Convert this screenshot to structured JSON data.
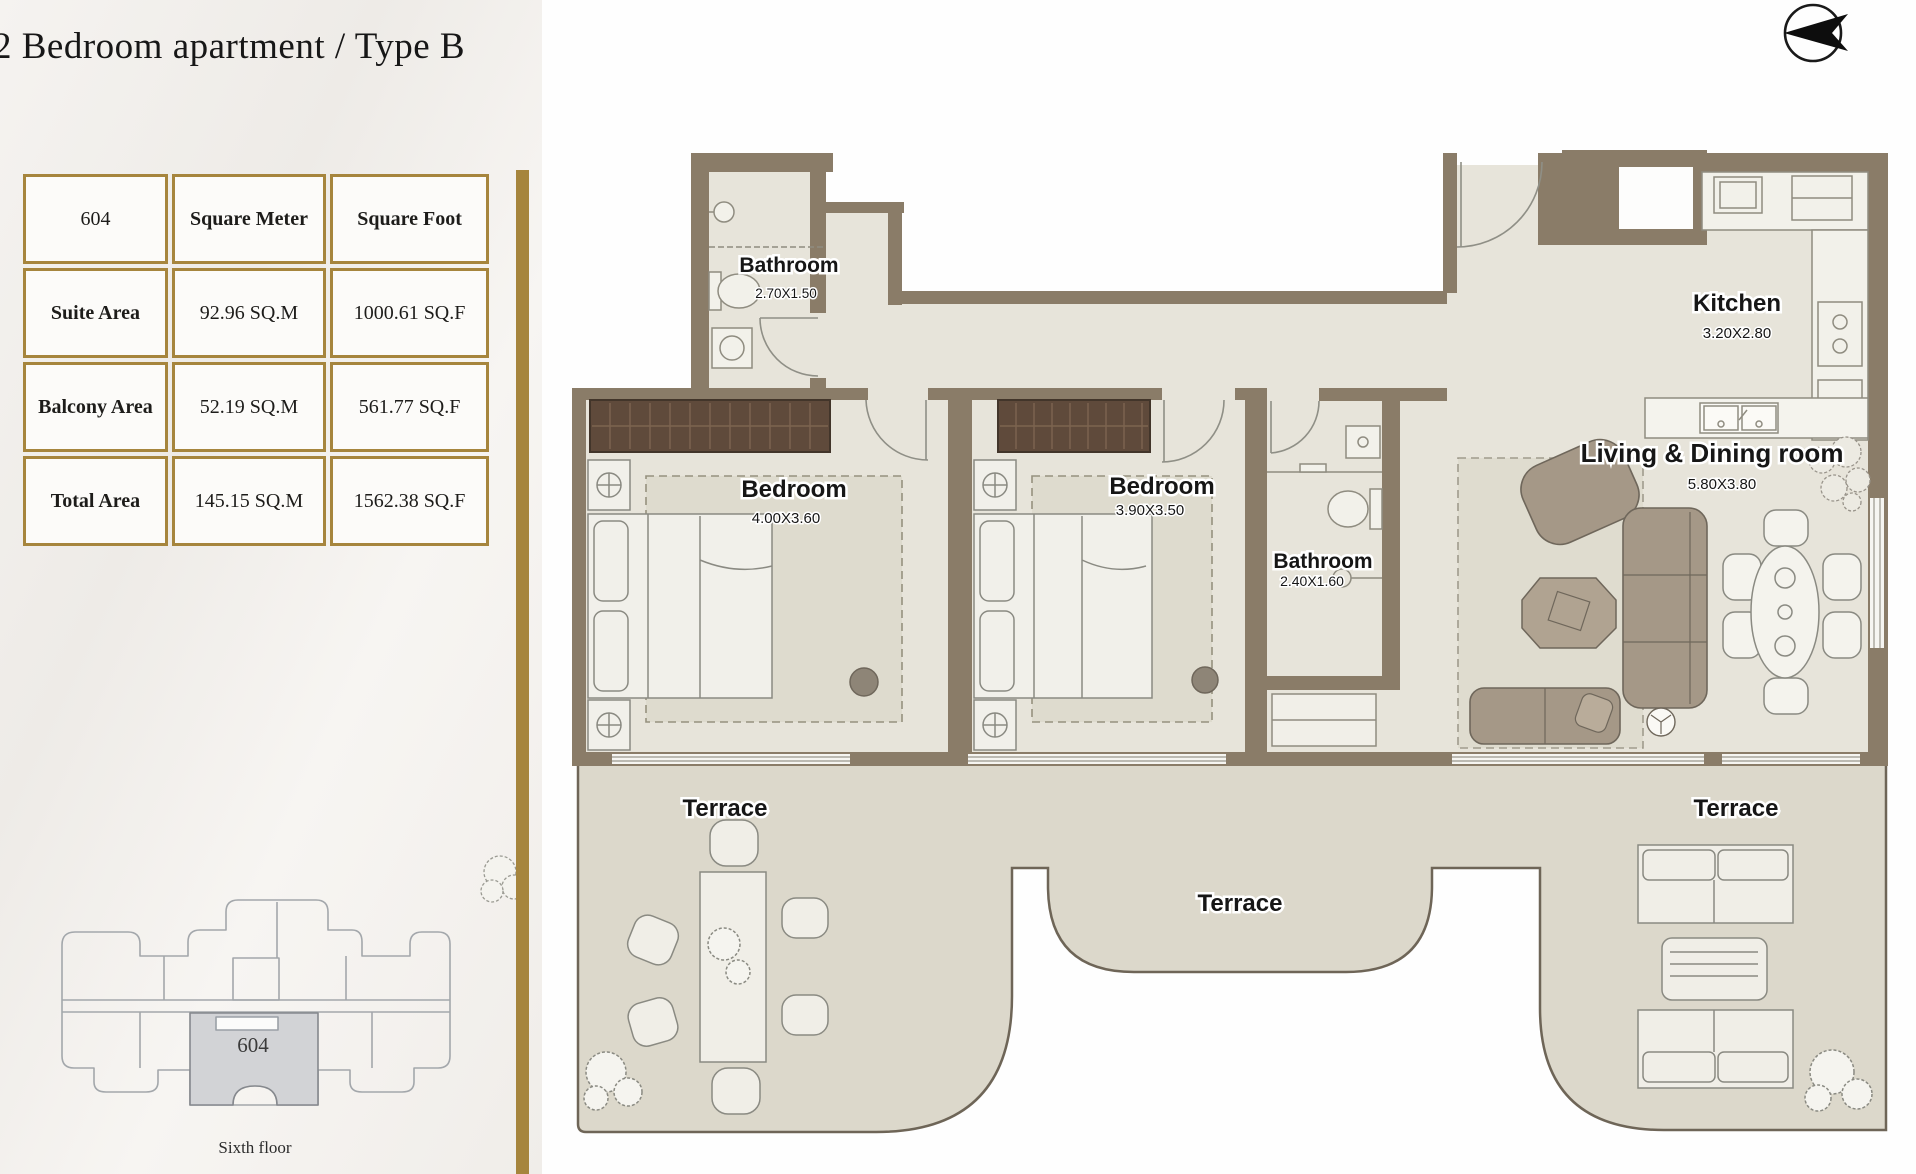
{
  "title": "2 Bedroom apartment / Type B",
  "compass": {
    "icon": "north-arrow-left"
  },
  "area_table": {
    "unit": "604",
    "col_sqm": "Square Meter",
    "col_sqf": "Square Foot",
    "rows": [
      {
        "label": "Suite  Area",
        "sqm": "92.96 SQ.M",
        "sqf": "1000.61 SQ.F"
      },
      {
        "label": "Balcony Area",
        "sqm": "52.19 SQ.M",
        "sqf": "561.77 SQ.F"
      },
      {
        "label": "Total Area",
        "sqm": "145.15 SQ.M",
        "sqf": "1562.38 SQ.F"
      }
    ]
  },
  "key_plan": {
    "unit": "604",
    "floor": "Sixth floor"
  },
  "rooms": {
    "bathroom_top": {
      "name": "Bathroom",
      "dims": "2.70X1.50"
    },
    "bedroom_1": {
      "name": "Bedroom",
      "dims": "4.00X3.60"
    },
    "bedroom_2": {
      "name": "Bedroom",
      "dims": "3.90X3.50"
    },
    "bathroom_mid": {
      "name": "Bathroom",
      "dims": "2.40X1.60"
    },
    "kitchen": {
      "name": "Kitchen",
      "dims": "3.20X2.80"
    },
    "living": {
      "name": "Living & Dining room",
      "dims": "5.80X3.80"
    },
    "terrace_left": {
      "name": "Terrace"
    },
    "terrace_center": {
      "name": "Terrace"
    },
    "terrace_right": {
      "name": "Terrace"
    }
  },
  "colors": {
    "gold": "#a6853d",
    "wall": "#8a7c68",
    "floor": "#e7e4da",
    "terrace_floor": "#dcd8cb",
    "wardrobe": "#5f4a3b",
    "sofa": "#a59887",
    "unit_highlight": "#d2d3d6",
    "label_text": "#161616"
  }
}
